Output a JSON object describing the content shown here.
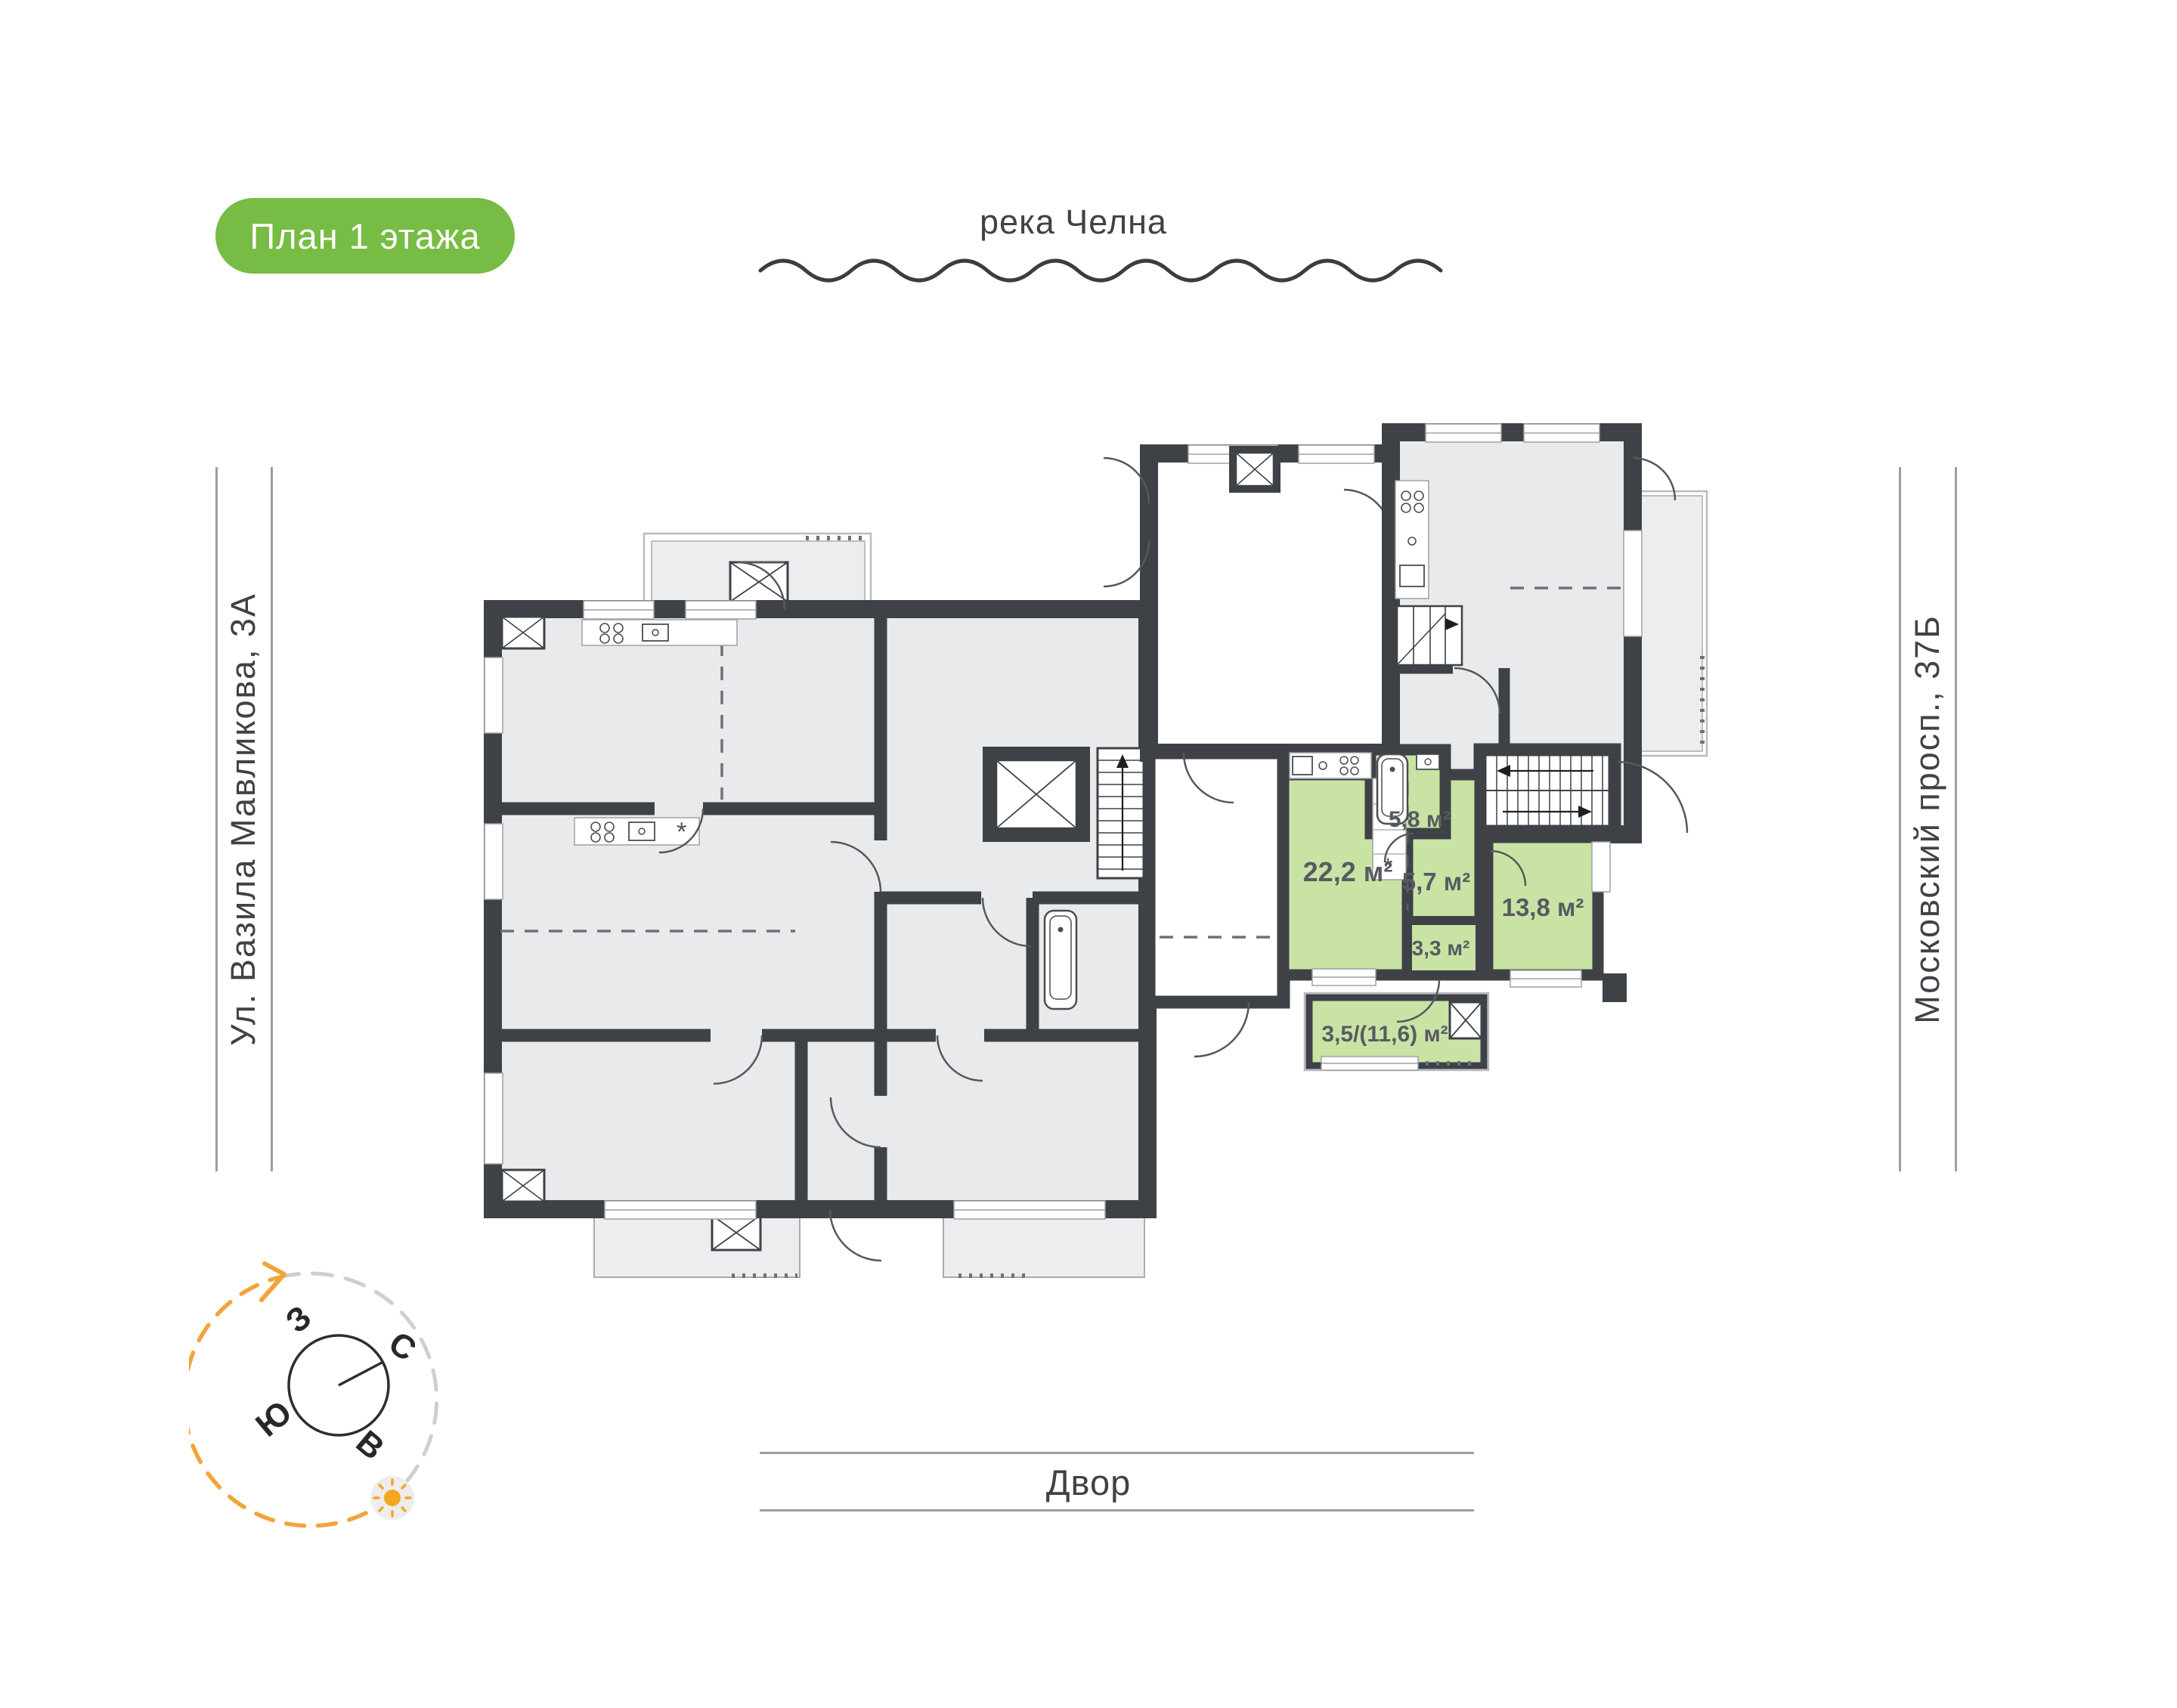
{
  "badge": {
    "label": "План 1 этажа",
    "bg_color": "#77BC44"
  },
  "landmarks": {
    "river": "река Челна",
    "yard": "Двор",
    "street_left": "Ул. Вазила Мавликова, 3А",
    "street_right": "Московский просп., 37Б"
  },
  "compass": {
    "north": "С",
    "south": "Ю",
    "west": "З",
    "east": "В",
    "arc_color": "#F2A43C"
  },
  "apartment": {
    "highlight_color": "#C9E3A4",
    "rooms": [
      {
        "name": "kitchen-living-room",
        "area": "22,2 м²"
      },
      {
        "name": "bathroom",
        "area": "5,8 м²"
      },
      {
        "name": "hallway",
        "area": "5,7 м²"
      },
      {
        "name": "bedroom",
        "area": "13,8 м²"
      },
      {
        "name": "wardrobe",
        "area": "3,3 м²"
      },
      {
        "name": "balcony",
        "area": "3,5/(11,6) м²"
      }
    ]
  },
  "plan": {
    "wall_color": "#3E4247",
    "room_fill": "#E8EAEC",
    "outdoor_fill": "#ECEDEF"
  }
}
